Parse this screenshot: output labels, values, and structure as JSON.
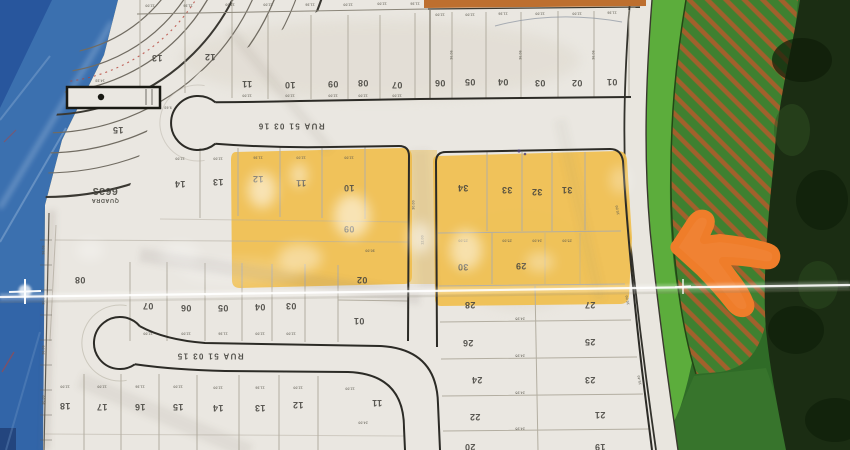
{
  "map": {
    "block_label": {
      "title": "QUADRA",
      "number": "6633"
    },
    "streets": [
      {
        "name": "RUA 51 03 16",
        "x": 291,
        "y": 126
      },
      {
        "name": "RUA 51 03 15",
        "x": 210,
        "y": 356
      }
    ],
    "lot_numbers": [
      {
        "t": "13",
        "x": 157,
        "y": 58
      },
      {
        "t": "12",
        "x": 210,
        "y": 57
      },
      {
        "t": "11",
        "x": 247,
        "y": 84
      },
      {
        "t": "10",
        "x": 290,
        "y": 85
      },
      {
        "t": "09",
        "x": 333,
        "y": 84
      },
      {
        "t": "08",
        "x": 363,
        "y": 83
      },
      {
        "t": "07",
        "x": 397,
        "y": 85
      },
      {
        "t": "06",
        "x": 440,
        "y": 83
      },
      {
        "t": "05",
        "x": 470,
        "y": 82
      },
      {
        "t": "04",
        "x": 503,
        "y": 82
      },
      {
        "t": "03",
        "x": 540,
        "y": 83
      },
      {
        "t": "02",
        "x": 577,
        "y": 83
      },
      {
        "t": "01",
        "x": 612,
        "y": 82
      },
      {
        "t": "15",
        "x": 118,
        "y": 130
      },
      {
        "t": "14",
        "x": 180,
        "y": 184
      },
      {
        "t": "13",
        "x": 218,
        "y": 182
      },
      {
        "t": "12",
        "x": 258,
        "y": 179
      },
      {
        "t": "11",
        "x": 301,
        "y": 183
      },
      {
        "t": "10",
        "x": 349,
        "y": 188
      },
      {
        "t": "09",
        "x": 349,
        "y": 229
      },
      {
        "t": "08",
        "x": 80,
        "y": 280
      },
      {
        "t": "07",
        "x": 148,
        "y": 306
      },
      {
        "t": "06",
        "x": 186,
        "y": 308
      },
      {
        "t": "05",
        "x": 223,
        "y": 308
      },
      {
        "t": "04",
        "x": 260,
        "y": 307
      },
      {
        "t": "03",
        "x": 291,
        "y": 306
      },
      {
        "t": "02",
        "x": 362,
        "y": 280
      },
      {
        "t": "01",
        "x": 359,
        "y": 321
      },
      {
        "t": "34",
        "x": 463,
        "y": 188
      },
      {
        "t": "33",
        "x": 507,
        "y": 190
      },
      {
        "t": "32",
        "x": 537,
        "y": 192
      },
      {
        "t": "31",
        "x": 567,
        "y": 190
      },
      {
        "t": "30",
        "x": 463,
        "y": 267
      },
      {
        "t": "29",
        "x": 521,
        "y": 266
      },
      {
        "t": "28",
        "x": 470,
        "y": 305
      },
      {
        "t": "27",
        "x": 590,
        "y": 305
      },
      {
        "t": "26",
        "x": 468,
        "y": 343
      },
      {
        "t": "25",
        "x": 590,
        "y": 342
      },
      {
        "t": "24",
        "x": 477,
        "y": 380
      },
      {
        "t": "23",
        "x": 590,
        "y": 380
      },
      {
        "t": "22",
        "x": 475,
        "y": 417
      },
      {
        "t": "21",
        "x": 600,
        "y": 415
      },
      {
        "t": "20",
        "x": 470,
        "y": 447
      },
      {
        "t": "19",
        "x": 600,
        "y": 447
      },
      {
        "t": "18",
        "x": 65,
        "y": 406
      },
      {
        "t": "17",
        "x": 102,
        "y": 407
      },
      {
        "t": "16",
        "x": 140,
        "y": 407
      },
      {
        "t": "15",
        "x": 178,
        "y": 407
      },
      {
        "t": "14",
        "x": 218,
        "y": 408
      },
      {
        "t": "13",
        "x": 260,
        "y": 408
      },
      {
        "t": "12",
        "x": 298,
        "y": 405
      },
      {
        "t": "11",
        "x": 377,
        "y": 403
      }
    ],
    "dimensions": [
      {
        "t": "12.00",
        "x": 150,
        "y": 5
      },
      {
        "t": "11.36",
        "x": 188,
        "y": 5
      },
      {
        "t": "12.00",
        "x": 230,
        "y": 4
      },
      {
        "t": "12.00",
        "x": 268,
        "y": 4
      },
      {
        "t": "11.36",
        "x": 310,
        "y": 4
      },
      {
        "t": "12.00",
        "x": 348,
        "y": 4
      },
      {
        "t": "12.00",
        "x": 382,
        "y": 3
      },
      {
        "t": "11.36",
        "x": 415,
        "y": 3
      },
      {
        "t": "12.00",
        "x": 440,
        "y": 14
      },
      {
        "t": "12.00",
        "x": 470,
        "y": 14
      },
      {
        "t": "11.36",
        "x": 503,
        "y": 13
      },
      {
        "t": "12.00",
        "x": 540,
        "y": 13
      },
      {
        "t": "12.00",
        "x": 577,
        "y": 13
      },
      {
        "t": "11.36",
        "x": 612,
        "y": 12
      },
      {
        "t": "36.06",
        "x": 452,
        "y": 55,
        "r": 90
      },
      {
        "t": "36.06",
        "x": 521,
        "y": 55,
        "r": 90
      },
      {
        "t": "36.06",
        "x": 594,
        "y": 55,
        "r": 90
      },
      {
        "t": "12.00",
        "x": 247,
        "y": 95
      },
      {
        "t": "12.00",
        "x": 290,
        "y": 95
      },
      {
        "t": "12.00",
        "x": 333,
        "y": 95
      },
      {
        "t": "12.00",
        "x": 363,
        "y": 95
      },
      {
        "t": "12.00",
        "x": 397,
        "y": 95
      },
      {
        "t": "14.33",
        "x": 100,
        "y": 80
      },
      {
        "t": "9.63",
        "x": 168,
        "y": 107
      },
      {
        "t": "12.00",
        "x": 180,
        "y": 158
      },
      {
        "t": "12.00",
        "x": 218,
        "y": 158
      },
      {
        "t": "11.36",
        "x": 258,
        "y": 157
      },
      {
        "t": "12.00",
        "x": 301,
        "y": 157
      },
      {
        "t": "12.00",
        "x": 349,
        "y": 157
      },
      {
        "t": "30.00",
        "x": 414,
        "y": 205,
        "r": 90
      },
      {
        "t": "30.00",
        "x": 370,
        "y": 250
      },
      {
        "t": "12.00",
        "x": 148,
        "y": 333
      },
      {
        "t": "12.00",
        "x": 186,
        "y": 333
      },
      {
        "t": "11.36",
        "x": 223,
        "y": 333
      },
      {
        "t": "12.00",
        "x": 260,
        "y": 333
      },
      {
        "t": "12.00",
        "x": 291,
        "y": 333
      },
      {
        "t": "25.00",
        "x": 463,
        "y": 240
      },
      {
        "t": "25.00",
        "x": 507,
        "y": 240
      },
      {
        "t": "24.00",
        "x": 537,
        "y": 240
      },
      {
        "t": "25.00",
        "x": 567,
        "y": 240
      },
      {
        "t": "24.95",
        "x": 520,
        "y": 318
      },
      {
        "t": "24.95",
        "x": 520,
        "y": 355
      },
      {
        "t": "24.95",
        "x": 520,
        "y": 392
      },
      {
        "t": "24.95",
        "x": 520,
        "y": 428
      },
      {
        "t": "10.00",
        "x": 618,
        "y": 210,
        "r": 80
      },
      {
        "t": "10.00",
        "x": 628,
        "y": 300,
        "r": 80
      },
      {
        "t": "15.40",
        "x": 640,
        "y": 380,
        "r": 80
      },
      {
        "t": "36.06",
        "x": 44,
        "y": 250,
        "r": 90
      },
      {
        "t": "30.00",
        "x": 44,
        "y": 300,
        "r": 90
      },
      {
        "t": "36.06",
        "x": 44,
        "y": 350,
        "r": 90
      },
      {
        "t": "30.00",
        "x": 44,
        "y": 400,
        "r": 90
      },
      {
        "t": "12.00",
        "x": 65,
        "y": 386
      },
      {
        "t": "12.00",
        "x": 102,
        "y": 386
      },
      {
        "t": "11.36",
        "x": 140,
        "y": 386
      },
      {
        "t": "12.00",
        "x": 178,
        "y": 386
      },
      {
        "t": "12.00",
        "x": 218,
        "y": 387
      },
      {
        "t": "11.36",
        "x": 260,
        "y": 387
      },
      {
        "t": "12.00",
        "x": 298,
        "y": 387
      },
      {
        "t": "12.00",
        "x": 350,
        "y": 388
      },
      {
        "t": "24.00",
        "x": 363,
        "y": 422
      },
      {
        "t": "12.00",
        "x": 423,
        "y": 240,
        "r": 90
      }
    ],
    "colors": {
      "paper": "#eae7e1",
      "highlight_marker": "#f0bf4e",
      "fabric_blue": "#3b70af",
      "green_zone": "#3f8030",
      "green_bright": "#5cad3c",
      "green_dark": "#1b2d13",
      "hatch_stripe": "#a2602c",
      "arrow_orange": "#ef7d2a",
      "street_ink": "#2c2b26",
      "lot_line": "#b3aea1"
    }
  },
  "annotations": {
    "arrow": "orange-left-arrow",
    "highlight": "yellow-marker-over-lots"
  }
}
